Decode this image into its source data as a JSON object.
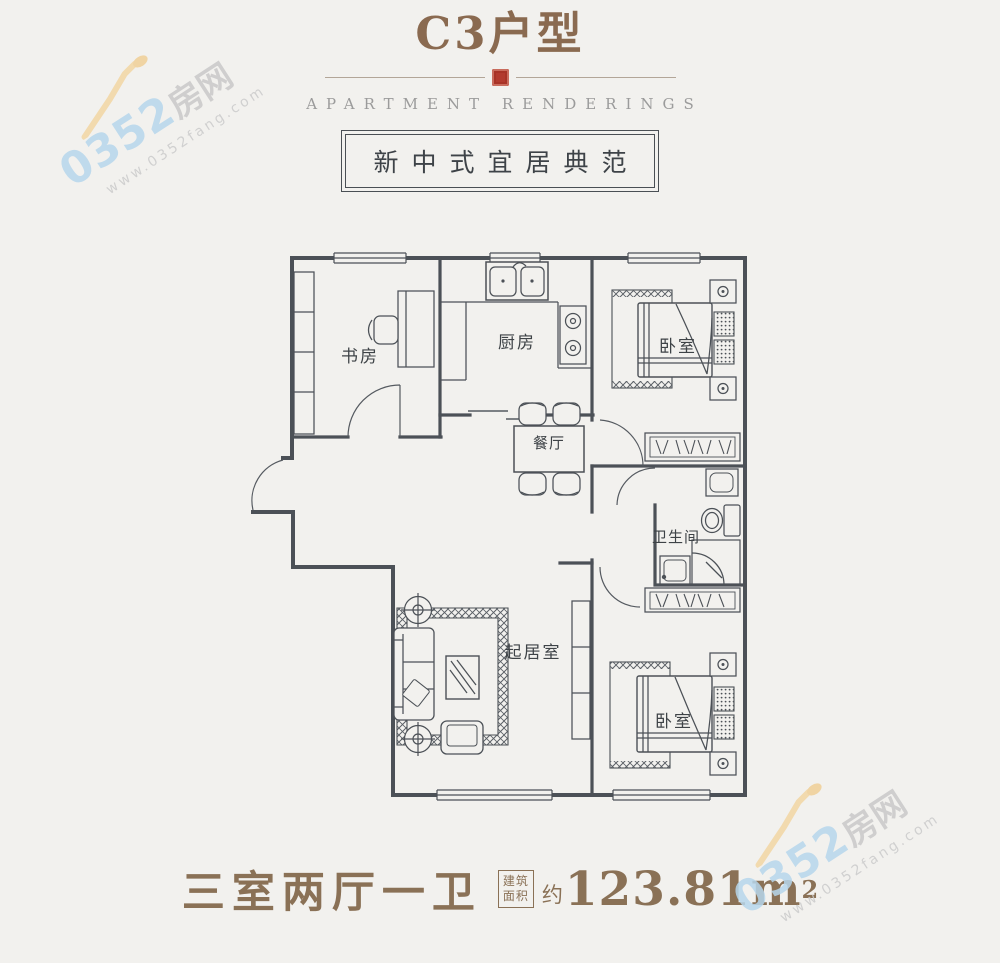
{
  "header": {
    "title": "C3户型",
    "subtitle": "APARTMENT RENDERINGS",
    "tagline": "新中式宜居典范"
  },
  "floorplan": {
    "rooms": [
      {
        "id": "study",
        "label": "书房"
      },
      {
        "id": "kitchen",
        "label": "厨房"
      },
      {
        "id": "bedroom1",
        "label": "卧室"
      },
      {
        "id": "dining",
        "label": "餐厅"
      },
      {
        "id": "bathroom",
        "label": "卫生间"
      },
      {
        "id": "living",
        "label": "起居室"
      },
      {
        "id": "bedroom2",
        "label": "卧室"
      }
    ]
  },
  "caption": {
    "layout": "三室两厅一卫",
    "area_label_line1": "建筑",
    "area_label_line2": "面积",
    "approx": "约",
    "area_value": "123.81m",
    "area_sup": "2"
  },
  "watermark": {
    "number": "0352",
    "name": "房网",
    "url": "www.0352fang.com"
  },
  "colors": {
    "background": "#f2f1ee",
    "title_brown": "#8a6a50",
    "caption_brown": "#8a7156",
    "seal_red": "#b23a2e",
    "plan_line": "#4c5157",
    "watermark_blue": "#b7d7ec",
    "watermark_gray": "#c9c9c9",
    "watermark_orange": "#f2d6a4"
  }
}
